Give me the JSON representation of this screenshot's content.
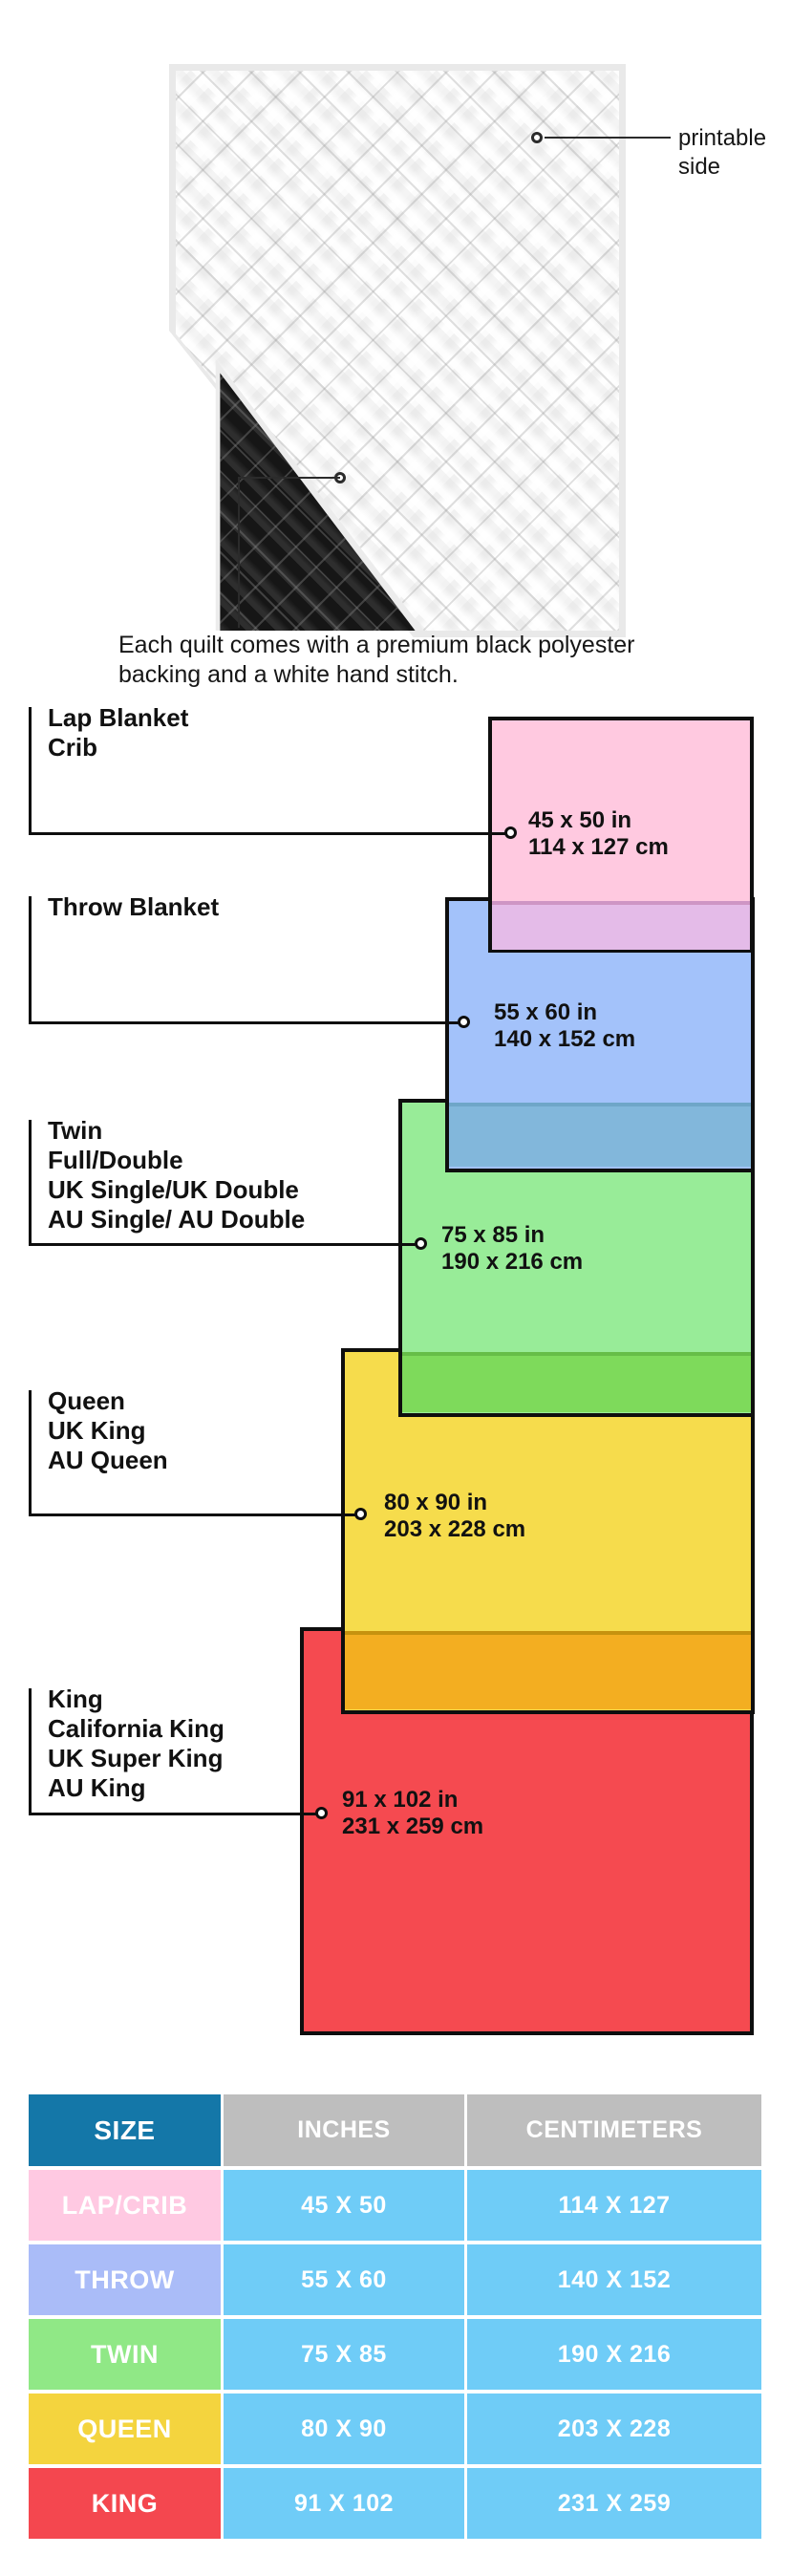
{
  "quilt": {
    "printable_side": {
      "line1": "printable",
      "line2": "side"
    },
    "caption": {
      "line1": "Each quilt comes with a premium black polyester",
      "line2": "backing and a white hand stitch."
    },
    "colors": {
      "front": "#fbfbfb",
      "backing": "#161616"
    }
  },
  "diagram": {
    "groups": [
      {
        "labels": [
          "Lap Blanket",
          "Crib"
        ],
        "inches": "45 x 50 in",
        "cm": "114 x 127 cm",
        "fill": "#FFC9E0",
        "overlap_below": "#E4BBE8"
      },
      {
        "labels": [
          "Throw Blanket"
        ],
        "inches": "55 x 60 in",
        "cm": "140 x 152 cm",
        "fill": "#A3C2FA",
        "overlap_below": "#82B7DB"
      },
      {
        "labels": [
          "Twin",
          "Full/Double",
          "UK Single/UK Double",
          "AU Single/ AU Double"
        ],
        "inches": "75 x 85 in",
        "cm": "190 x 216 cm",
        "fill": "#98EC98",
        "overlap_below": "#7EDA5B"
      },
      {
        "labels": [
          "Queen",
          "UK King",
          "AU Queen"
        ],
        "inches": "80 x 90 in",
        "cm": "203 x 228 cm",
        "fill": "#F6DC4C",
        "overlap_below": "#F3AE21"
      },
      {
        "labels": [
          "King",
          "California King",
          "UK Super King",
          "AU King"
        ],
        "inches": "91 x 102 in",
        "cm": "231 x 259 cm",
        "fill": "#F54A50",
        "overlap_below": null
      }
    ]
  },
  "table": {
    "headers": {
      "size": "SIZE",
      "inches": "INCHES",
      "centimeters": "CENTIMETERS"
    },
    "header_colors": {
      "size_bg": "#1477A8",
      "other_bg": "#BEBEBE",
      "text": "#ffffff"
    },
    "value_bg": "#6FCCF7",
    "rows": [
      {
        "size": "LAP/CRIB",
        "inches": "45 X 50",
        "cm": "114 X 127",
        "color": "#FFC9E2"
      },
      {
        "size": "THROW",
        "inches": "55 X 60",
        "cm": "140 X 152",
        "color": "#AABCF8"
      },
      {
        "size": "TWIN",
        "inches": "75 X 85",
        "cm": "190 X 216",
        "color": "#90E886"
      },
      {
        "size": "QUEEN",
        "inches": "80 X 90",
        "cm": "203 X 228",
        "color": "#F4D43E"
      },
      {
        "size": "KING",
        "inches": "91 X 102",
        "cm": "231 X 259",
        "color": "#F4474F"
      }
    ]
  }
}
